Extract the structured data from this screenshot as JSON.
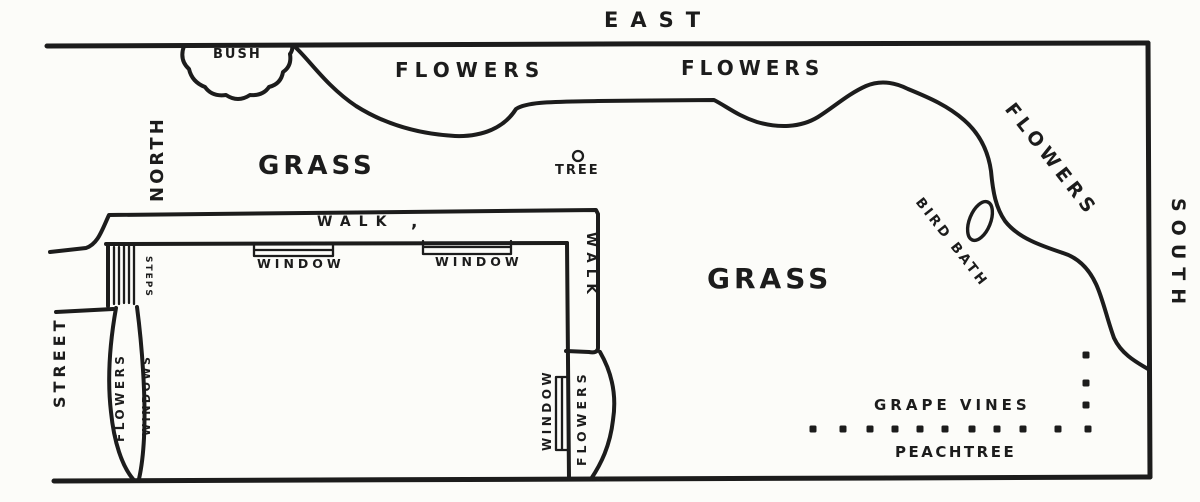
{
  "compass": {
    "east": "EAST",
    "north": "NORTH",
    "south": "SOUTH"
  },
  "street_label": "STREET",
  "garden": {
    "bush": "BUSH",
    "flowers_top_left": "FLOWERS",
    "flowers_top_right": "FLOWERS",
    "flowers_right_bank": "FLOWERS",
    "flowers_by_street": "FLOWERS",
    "flowers_southeast": "FLOWERS",
    "grass_northwest": "GRASS",
    "grass_center": "GRASS",
    "tree": "TREE",
    "bird_bath": "BIRD BATH",
    "grape_vines": "GRAPE VINES",
    "peach_tree": "PEACHTREE"
  },
  "house": {
    "walk_top": "WALK",
    "walk_comma": ",",
    "walk_east": "WALK",
    "window_north_left": "WINDOW",
    "window_north_right": "WINDOW",
    "window_east": "WINDOW",
    "windows_west": "WINDOWS",
    "steps": "STEPS"
  },
  "colors": {
    "ink": "#1c1c1c",
    "paper": "#fcfcf9"
  },
  "grape_vine_dots": {
    "row_y": 429,
    "row_x": [
      813,
      843,
      870,
      895,
      920,
      945,
      972,
      997,
      1023,
      1058,
      1088
    ],
    "col_x": 1086,
    "col_y": [
      355,
      383,
      405
    ],
    "size": 7
  }
}
